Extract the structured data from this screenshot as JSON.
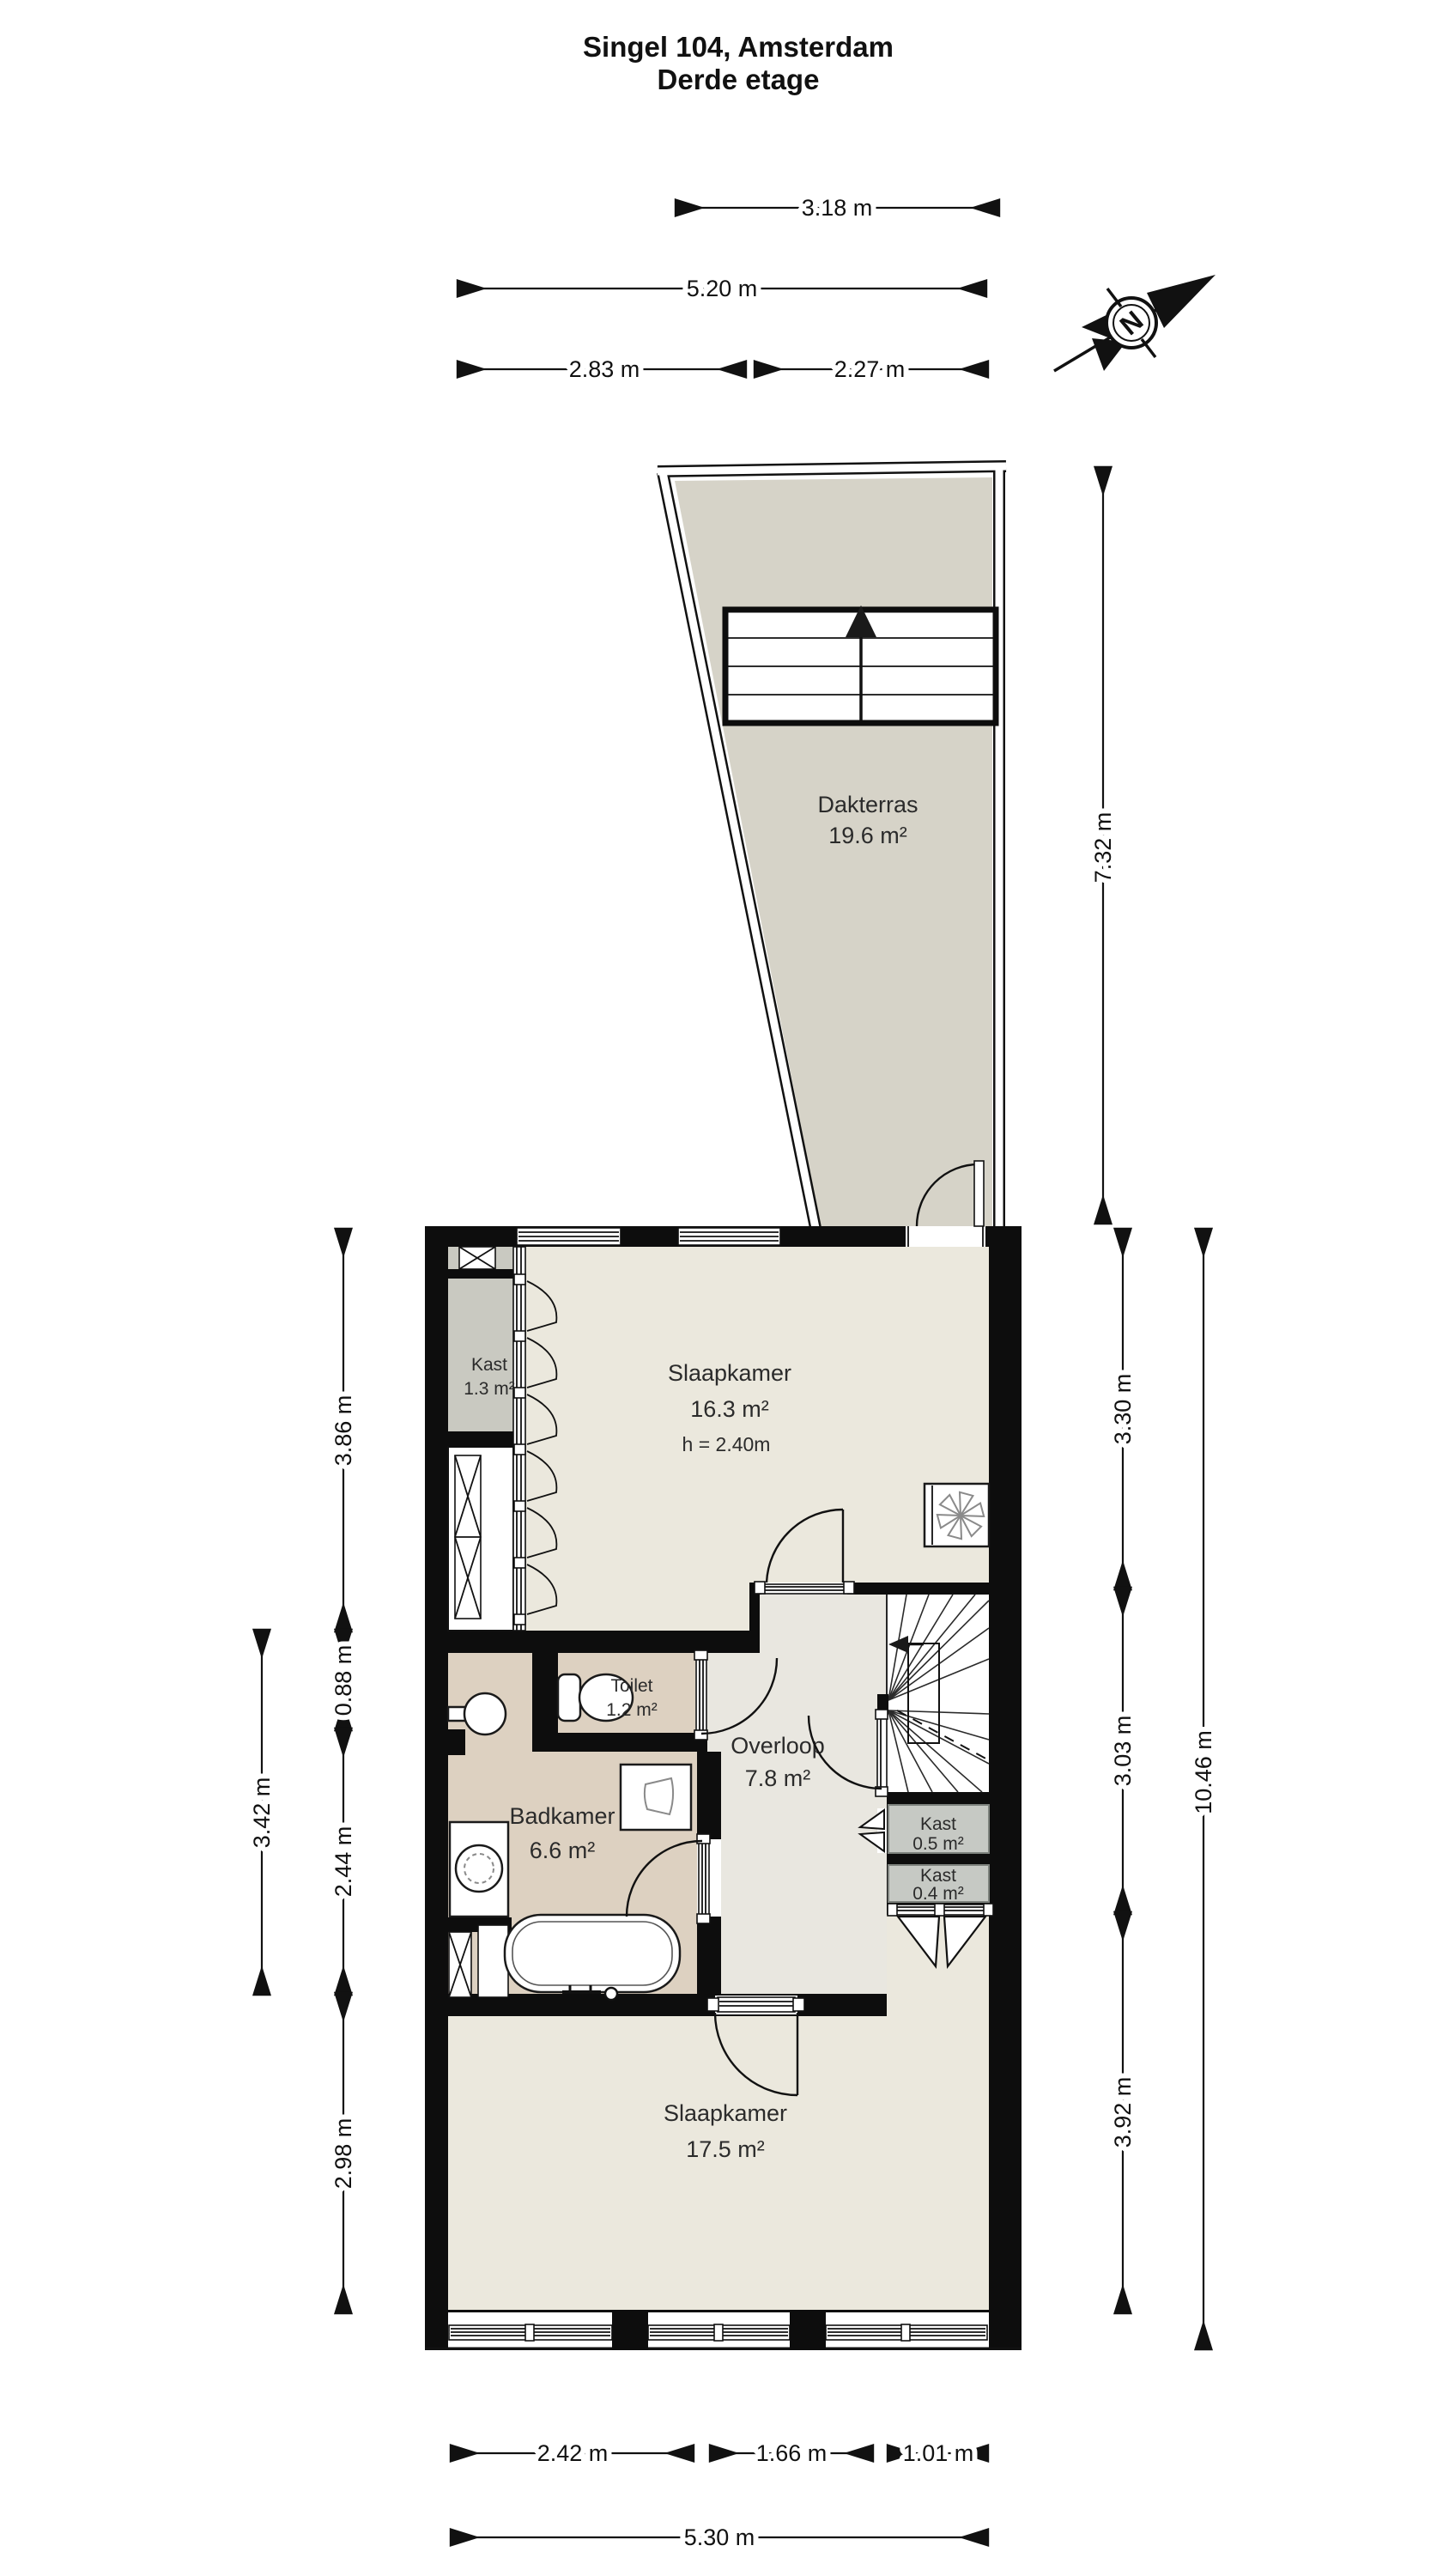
{
  "title": {
    "line1": "Singel 104, Amsterdam",
    "line2": "Derde etage"
  },
  "compass": {
    "north_label": "N"
  },
  "rooms": {
    "dakterras": {
      "name": "Dakterras",
      "area": "19.6 m²"
    },
    "slaapkamer_boven": {
      "name": "Slaapkamer",
      "area": "16.3 m²",
      "ceiling_height": "h = 2.40m"
    },
    "kast_boven": {
      "name": "Kast",
      "area": "1.3 m²"
    },
    "toilet": {
      "name": "Toilet",
      "area": "1.2 m²"
    },
    "overloop": {
      "name": "Overloop",
      "area": "7.8 m²"
    },
    "badkamer": {
      "name": "Badkamer",
      "area": "6.6 m²"
    },
    "kast_overloop_groot": {
      "name": "Kast",
      "area": "0.5 m²"
    },
    "kast_overloop_klein": {
      "name": "Kast",
      "area": "0.4 m²"
    },
    "slaapkamer_onder": {
      "name": "Slaapkamer",
      "area": "17.5 m²"
    }
  },
  "dimensions": {
    "top": {
      "terras_breedte": "3.18 m",
      "totaal_boven": "5.20 m",
      "links_boven": "2.83 m",
      "rechts_boven": "2.27 m"
    },
    "right": {
      "terras_hoogte": "7.32 m",
      "slaapkamer_boven": "3.30 m",
      "midden": "3.03 m",
      "slaapkamer_onder": "3.92 m",
      "totaal": "10.46 m"
    },
    "left": {
      "kast_zone": "3.86 m",
      "toilet_zone": "0.88 m",
      "badkamer_totaal": "3.42 m",
      "badkamer": "2.44 m",
      "slaapkamer_onder": "2.98 m"
    },
    "bottom": {
      "raam_links": "2.42 m",
      "raam_midden": "1.66 m",
      "raam_rechts": "1.01 m",
      "totaal": "5.30 m"
    }
  },
  "colors": {
    "terrace": "#d6d3c8",
    "bedroom": "#ebe8dd",
    "hallway": "#e9e7e0",
    "bathroom": "#ddd1c1",
    "closet_large": "#c9c9c1",
    "closet_small": "#c6c9c4",
    "wall": "#0d0d0d"
  }
}
